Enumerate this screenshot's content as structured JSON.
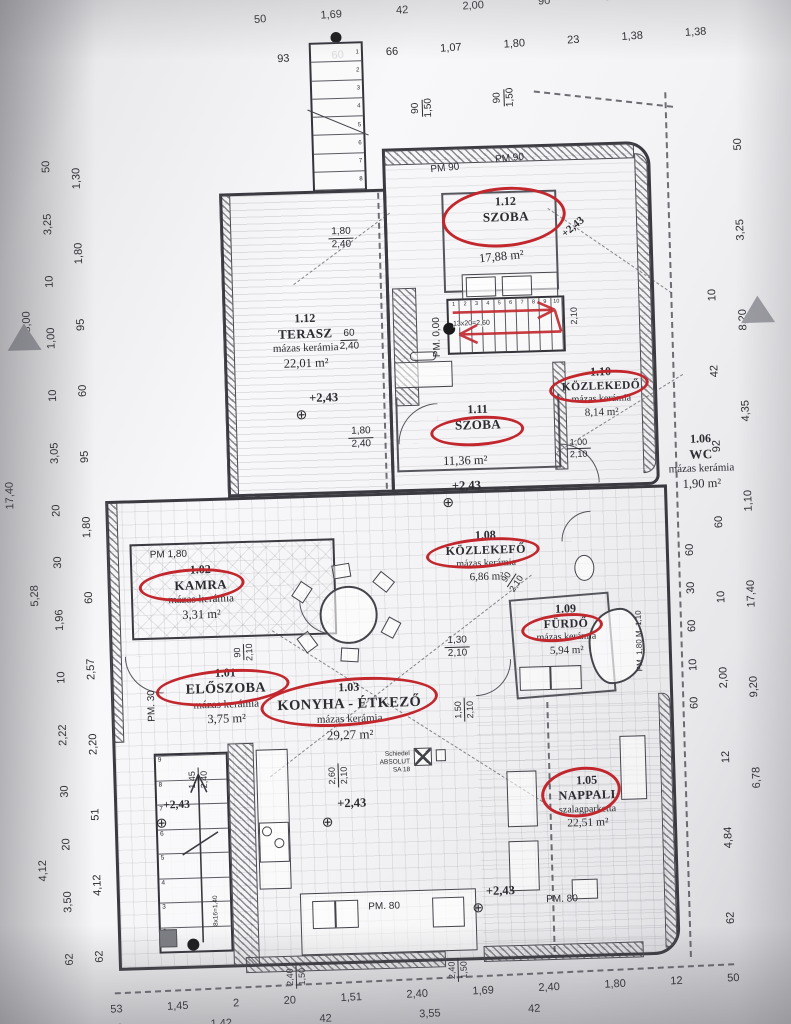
{
  "palette": {
    "red": "#c1272d",
    "ink": "#2b2b30"
  },
  "top_dims": {
    "row1": [
      "50",
      "1,69",
      "42",
      "2,00",
      "90",
      "52",
      "50"
    ],
    "row2": [
      "93",
      "60",
      "66",
      "1,07",
      "1,80",
      "23",
      "1,38",
      "1,38"
    ]
  },
  "bottom_dims": {
    "row1": [
      "53",
      "1,45",
      "2",
      "20",
      "1,51",
      "2,40",
      "1,69",
      "2,40",
      "1,80",
      "12",
      "50"
    ],
    "row2": [
      "53",
      "1,42",
      "42",
      "3,55",
      "42"
    ]
  },
  "left_dims": {
    "L1": [
      "17,40"
    ],
    "L2": [
      "8,00",
      "5,28",
      "4,12"
    ],
    "L3": [
      "50",
      "3,25",
      "10",
      "1,00",
      "10",
      "3,05",
      "20",
      "30",
      "1,96",
      "10",
      "2,22",
      "30",
      "20",
      "3,50",
      "62"
    ],
    "L4": [
      "1,30",
      "1,80",
      "95",
      "60",
      "95",
      "1,80",
      "60",
      "2,57",
      "2,20",
      "51",
      "4,12",
      "62"
    ]
  },
  "right_dims": {
    "R_outer": [
      "50",
      "3,25",
      "8,20",
      "4,35",
      "1,10",
      "17,40",
      "9,20",
      "6,78"
    ],
    "R_mid": [
      "10",
      "42",
      "92",
      "60",
      "10",
      "2,00",
      "12",
      "4,84",
      "62"
    ],
    "R_inner": [
      "60",
      "30",
      "60",
      "10",
      "60"
    ]
  },
  "rooms": {
    "terasz": {
      "num": "1.12",
      "name": "TERASZ",
      "finish": "mázas kerámia",
      "area": "22,01 m²"
    },
    "szoba12": {
      "num": "1.12",
      "name": "SZOBA",
      "area": "17,88 m²"
    },
    "szoba11": {
      "num": "1.11",
      "name": "SZOBA",
      "area": "11,36 m²"
    },
    "kozlekedo10": {
      "num": "1.10",
      "name": "KÖZLEKEDŐ",
      "finish": "mázas kerámia",
      "area": "8,14 m²"
    },
    "wc": {
      "num": "1.06",
      "name": "WC",
      "finish": "mázas kerámia",
      "area": "1,90 m²"
    },
    "kozlekedo08": {
      "num": "1.08",
      "name": "KÖZLEKEFŐ",
      "finish": "mázas kerámia",
      "area": "6,86 m²"
    },
    "kamra": {
      "num": "1.02",
      "name": "KAMRA",
      "finish": "mázas kerámia",
      "area": "3,31 m²"
    },
    "eloszoba": {
      "num": "1.01",
      "name": "ELŐSZOBA",
      "finish": "mázas kerámia",
      "area": "3,75 m²"
    },
    "konyha": {
      "num": "1.03",
      "name": "KONYHA - ÉTKEZŐ",
      "finish": "mázas kerámia",
      "area": "29,27 m²"
    },
    "furdo": {
      "num": "1.09",
      "name": "FÜRDŐ",
      "finish": "mázas kerámia",
      "area": "5,94 m²"
    },
    "nappali": {
      "num": "1.05",
      "name": "NAPPALI",
      "finish": "szalagparketta",
      "area": "22,51 m²"
    }
  },
  "levels": {
    "plus243": "+2,43",
    "pm000": "PM. 0,00",
    "pm90": "PM 90",
    "pm180": "PM 1,80",
    "pm30": "PM. 30",
    "pm80": "PM. 80",
    "pm180m110": "PM. 1,80 M. 1,10"
  },
  "stairs": {
    "upper_formula": "13x20=2,60",
    "lower_formula": "8x16=1,40",
    "dim210": "2,10",
    "upper_steps": [
      "1",
      "2",
      "3",
      "4",
      "5",
      "6",
      "7",
      "8",
      "9",
      "10"
    ],
    "top_steps": [
      "1",
      "2",
      "3",
      "4",
      "5",
      "6",
      "7",
      "8"
    ],
    "lower_steps": [
      "9",
      "8",
      "7",
      "6",
      "5",
      "4",
      "3",
      "2"
    ]
  },
  "dims": {
    "w90_150": {
      "a": "90",
      "b": "1,50"
    },
    "w180_240": {
      "a": "1,80",
      "b": "2,40"
    },
    "w60_240": {
      "a": "60",
      "b": "2,40"
    },
    "d100_210": {
      "a": "1,00",
      "b": "2,10"
    },
    "d90_210": {
      "a": "90",
      "b": "2,10"
    },
    "d130_210": {
      "a": "1,30",
      "b": "2,10"
    },
    "d150_210": {
      "a": "1,50",
      "b": "2,10"
    },
    "d260_210": {
      "a": "2,60",
      "b": "2,10"
    },
    "d145_240": {
      "a": "1,45",
      "b": "2,40"
    },
    "w240_150": {
      "a": "2,40",
      "b": "1,50"
    }
  },
  "chimney": {
    "line1": "Schiedel ABSOLUT",
    "line2": "SA 18"
  }
}
